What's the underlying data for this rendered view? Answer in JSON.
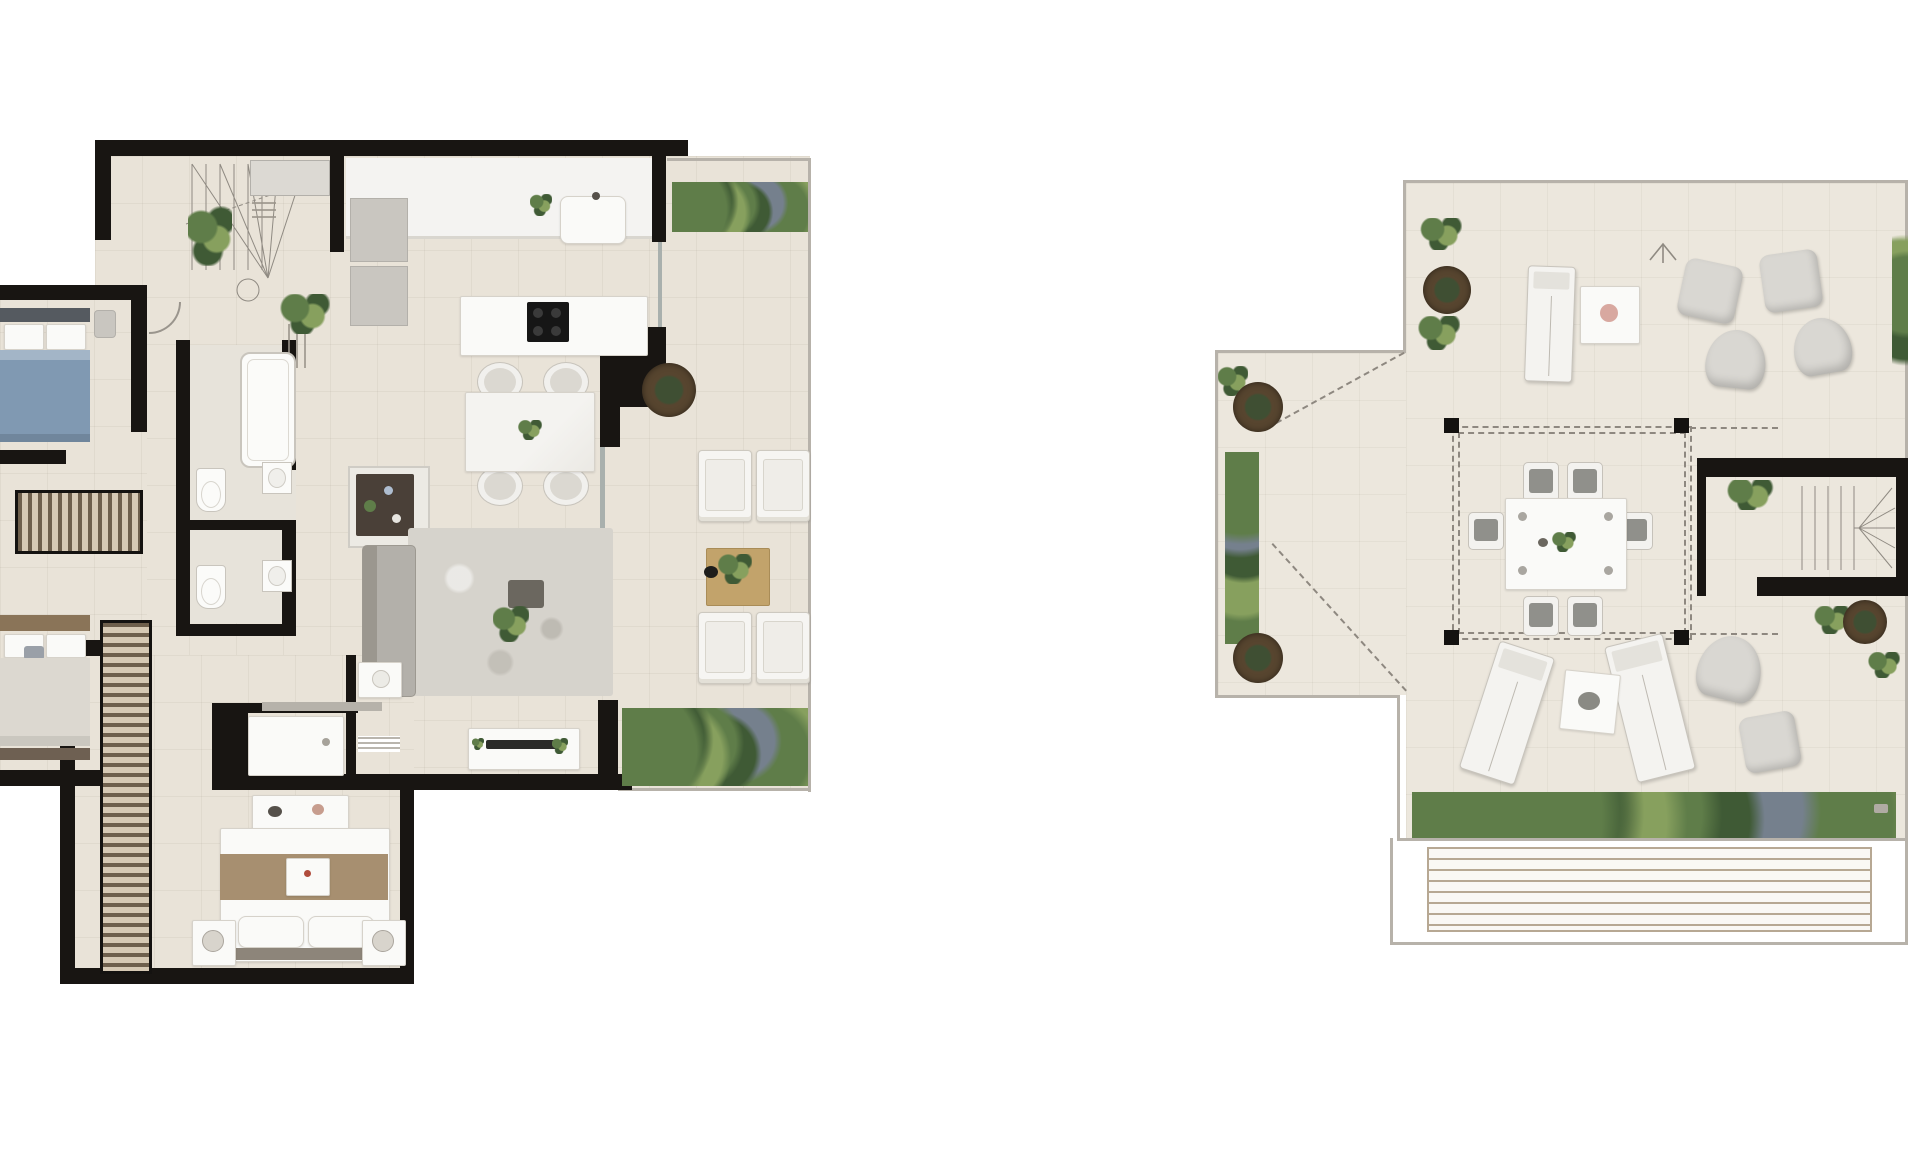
{
  "canvas": {
    "width": 1920,
    "height": 1166,
    "background": "#ffffff"
  },
  "palette": {
    "floor": "#e9e3d8",
    "floor_roof": "#ece7dd",
    "wall": "#181512",
    "fixture_white": "#fafaf8",
    "fixture_border": "#d6d2ca",
    "gray_furniture": "#c9c6c0",
    "rug": "#d6d3cc",
    "sofa": "#b3b0aa",
    "wood": "#c2a36b",
    "wardrobe_dark": "#6e5f4c",
    "wardrobe_light": "#d6c9b4",
    "hedge_dark": "#3f5a35",
    "hedge_mid": "#5f7d49",
    "hedge_light": "#87a05e",
    "hedge_blue": "#75808d",
    "planter_rim": "#57452f",
    "planter_core": "#3f4f33",
    "bed_blue": "#8099b2",
    "bed_tan": "#a78f70",
    "glass": "#a9b0ad",
    "outline": "#b7b2aa",
    "dash": "#8e8880",
    "cooktop": "#161616",
    "pink": "#d8a8a0"
  },
  "plans": [
    {
      "id": "main-floor",
      "rooms": [
        "staircase-hall",
        "kitchen",
        "living-dining-room",
        "bedroom-1",
        "bedroom-2",
        "master-bedroom",
        "bathroom-1",
        "bathroom-2",
        "shower-room",
        "walk-in-wardrobe",
        "terrace"
      ],
      "furniture": [
        "staircase",
        "fridge-cabinets",
        "kitchen-sink",
        "kitchen-island-with-cooktop",
        "dining-table-with-4-chairs",
        "sideboard",
        "sofa",
        "area-rug",
        "tv-console",
        "bathtub",
        "toilet",
        "washbasin",
        "shower-tray",
        "vanity",
        "double-bed-blue",
        "double-bed-tan",
        "master-double-bed",
        "nightstands-with-lamps",
        "dresser",
        "wardrobe-units",
        "terrace-armchairs-4",
        "terrace-wood-coffee-table",
        "round-planter-pot",
        "hedge-planters",
        "potted-ferns",
        "dimension-annotations"
      ]
    },
    {
      "id": "roof-terrace",
      "rooms": [
        "solarium-deck",
        "pergola-dining-area",
        "staircase",
        "timber-deck-strip"
      ],
      "furniture": [
        "dining-table-with-6-chairs",
        "sun-loungers-3",
        "side-tables-2",
        "bean-bag-poufs-6",
        "round-planter-pots-4",
        "vertical-planter-strip",
        "perimeter-hedges",
        "north-arrow",
        "floor-drain",
        "dashed-projection-lines"
      ]
    }
  ]
}
